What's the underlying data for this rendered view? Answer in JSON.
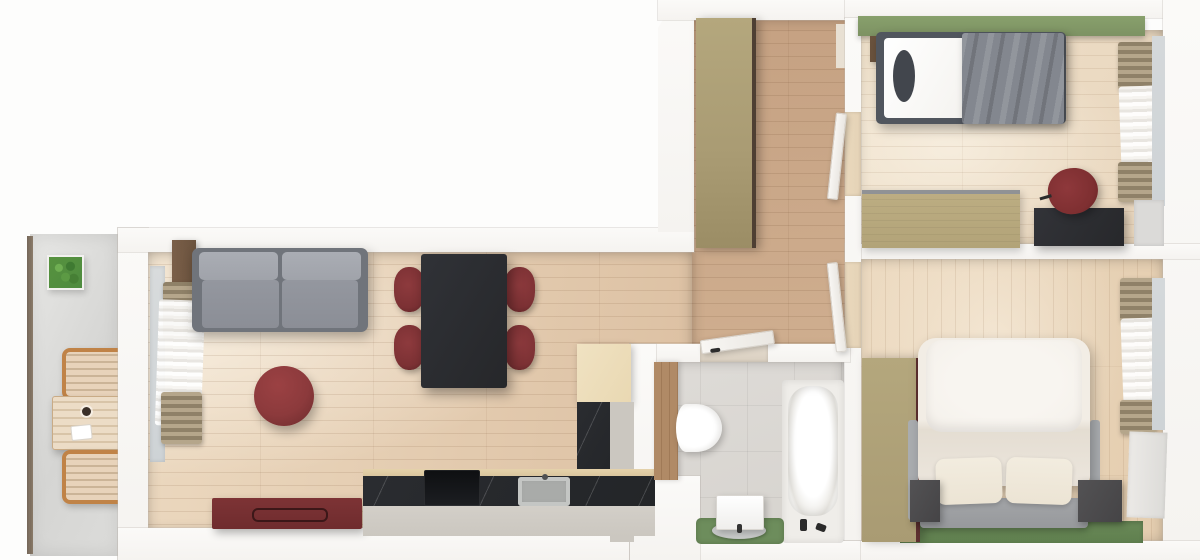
{
  "scene": {
    "title": "Top-down 3D rendered apartment floor plan",
    "view": "top-down render, no text labels",
    "rooms": [
      {
        "name": "Balcony",
        "furniture": [
          "wooden outdoor table",
          "two slatted wooden chairs",
          "potted green plant",
          "dark railing"
        ]
      },
      {
        "name": "Living room",
        "furniture": [
          "gray two-seat sofa",
          "round dark-red pouf",
          "dark-red sideboard",
          "balcony door with tan curtains and white sheer",
          "corner walnut shelf"
        ]
      },
      {
        "name": "Kitchen / dining",
        "furniture": [
          "black dining table",
          "four dark-red chairs",
          "L-shaped black stone counter",
          "cooktop",
          "steel sink",
          "maple tall cabinet",
          "greige base cabinets"
        ]
      },
      {
        "name": "Hallway",
        "furniture": [
          "tan full-height wardrobe",
          "two open white doors to bedrooms",
          "open white door to bathroom",
          "entry niche"
        ]
      },
      {
        "name": "Bathroom",
        "furniture": [
          "bathtub with black faucet",
          "wall-hung toilet",
          "wood wall panel",
          "washbasin cabinet with round tray",
          "green mat"
        ]
      },
      {
        "name": "Bedroom 1",
        "furniture": [
          "single bed with gray blanket and dark pillow",
          "green accent wall strip",
          "tan dresser bench",
          "black desk",
          "dark-red desk chair",
          "window with tan curtains"
        ]
      },
      {
        "name": "Bedroom 2",
        "furniture": [
          "double bed with cream duvet and two pillows",
          "tan wardrobe with dark-red edge",
          "two dark nightstands",
          "green floor strip",
          "window with tan curtains",
          "white radiator cabinet"
        ]
      }
    ]
  },
  "colors": {
    "wall": "#f5f3f0",
    "floor-living": "#dcc0a2",
    "floor-living-light": "#ecd9c0",
    "floor-hall": "#c5a182",
    "floor-hall-light": "#cfae8f",
    "floor-bed1": "#e8d5bc",
    "floor-bed1-light": "#f0e2cc",
    "floor-bed2": "#e4cdaf",
    "floor-bed2-light": "#eddbc2",
    "tile-bath": "#d6d3ce",
    "balcony-floor": "#dcdcda",
    "green-wall": "#7d9263",
    "green-floor": "#6a8a58",
    "green-mat": "#6d8d5c",
    "plant": "#4e8b3f",
    "red-chair": "#7c3134",
    "red-pouf": "#8c3a3c",
    "red-sideboard": "#6f2c2e",
    "red-desk-chair": "#7e2f31",
    "wardrobe-tan": "#a99b73",
    "wardrobe-edge": "#4e3f33",
    "wardrobe2-edge": "#5d3030",
    "dresser-tan": "#b2a378",
    "sofa-frame": "#70747b",
    "sofa-seat": "#8b8e96",
    "sofa-cushion": "#a0a3aa",
    "counter-stone": "#232528",
    "counter-wood": "#d9c49c",
    "cabinet-greige": "#cbc7c0",
    "cabinet-maple": "#e9d8b2",
    "table-black": "#26272a",
    "desk-black": "#27282b",
    "bed-frame": "#51565e",
    "mattress": "#f3f1ed",
    "pillow-dark": "#42464d",
    "blanket": "#83878f",
    "duvet": "#ece6dd",
    "euro-pillow": "#f4f0ea",
    "pillow-cream": "#ece4d4",
    "platform": "#97999c",
    "nightstand": "#454446",
    "glass": "#ced3d6",
    "curtain-tan-a": "#b5a68b",
    "curtain-tan-b": "#8f8168",
    "door": "#f5f3f0",
    "threshold": "#e4d2b6",
    "tub-deck": "#efede9",
    "basin-gray": "#b6b8b7",
    "wood-panel": "#b08a66",
    "walnut": "#6b533e",
    "balcony-wood": "#c08347",
    "balcony-slat": "#e8d3ba"
  }
}
